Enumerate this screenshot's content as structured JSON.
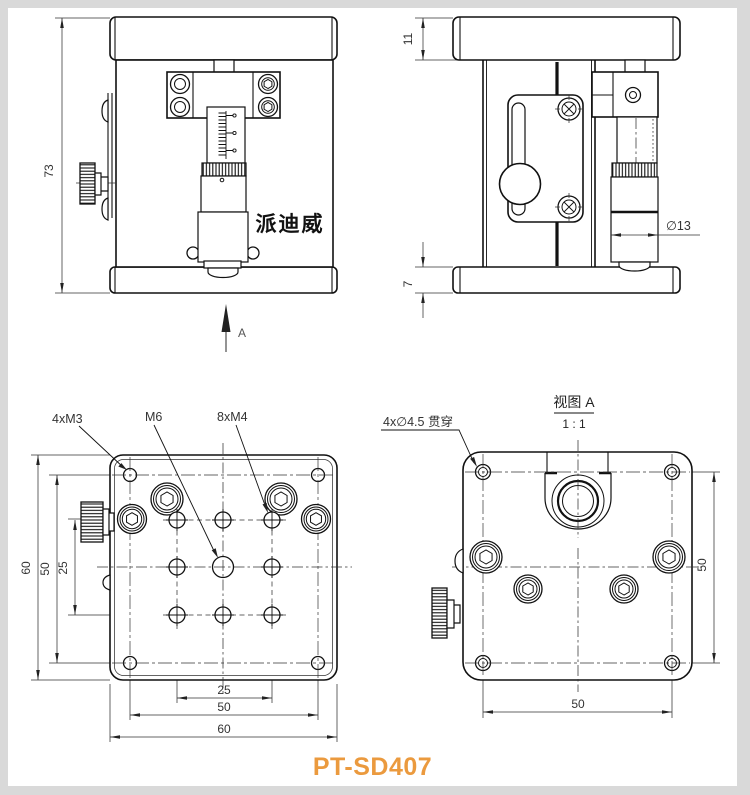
{
  "page": {
    "model": "PT-SD407",
    "colors": {
      "accent": "#EB9A3E",
      "line": "#111111",
      "frame": "#D9D9D9"
    }
  },
  "front_view": {
    "dim_height": "73",
    "arrow_label": "A",
    "brand_label": "派迪威"
  },
  "side_view": {
    "dim_top_plate_height": "11",
    "dim_base_height": "7",
    "dim_thimble_diameter": "∅13"
  },
  "top_view": {
    "label_corner_holes": "4xM3",
    "label_center_hole": "M6",
    "label_grid_holes": "8xM4",
    "dim_left_outer": "60",
    "dim_left_holes": "50",
    "dim_left_grid": "25",
    "dim_bottom_grid": "25",
    "dim_bottom_holes": "50",
    "dim_bottom_outer": "60"
  },
  "bottom_view": {
    "title": "视图 A",
    "scale": "1 : 1",
    "label_through_holes": "4x∅4.5 贯穿",
    "dim_right": "50",
    "dim_bottom": "50"
  }
}
